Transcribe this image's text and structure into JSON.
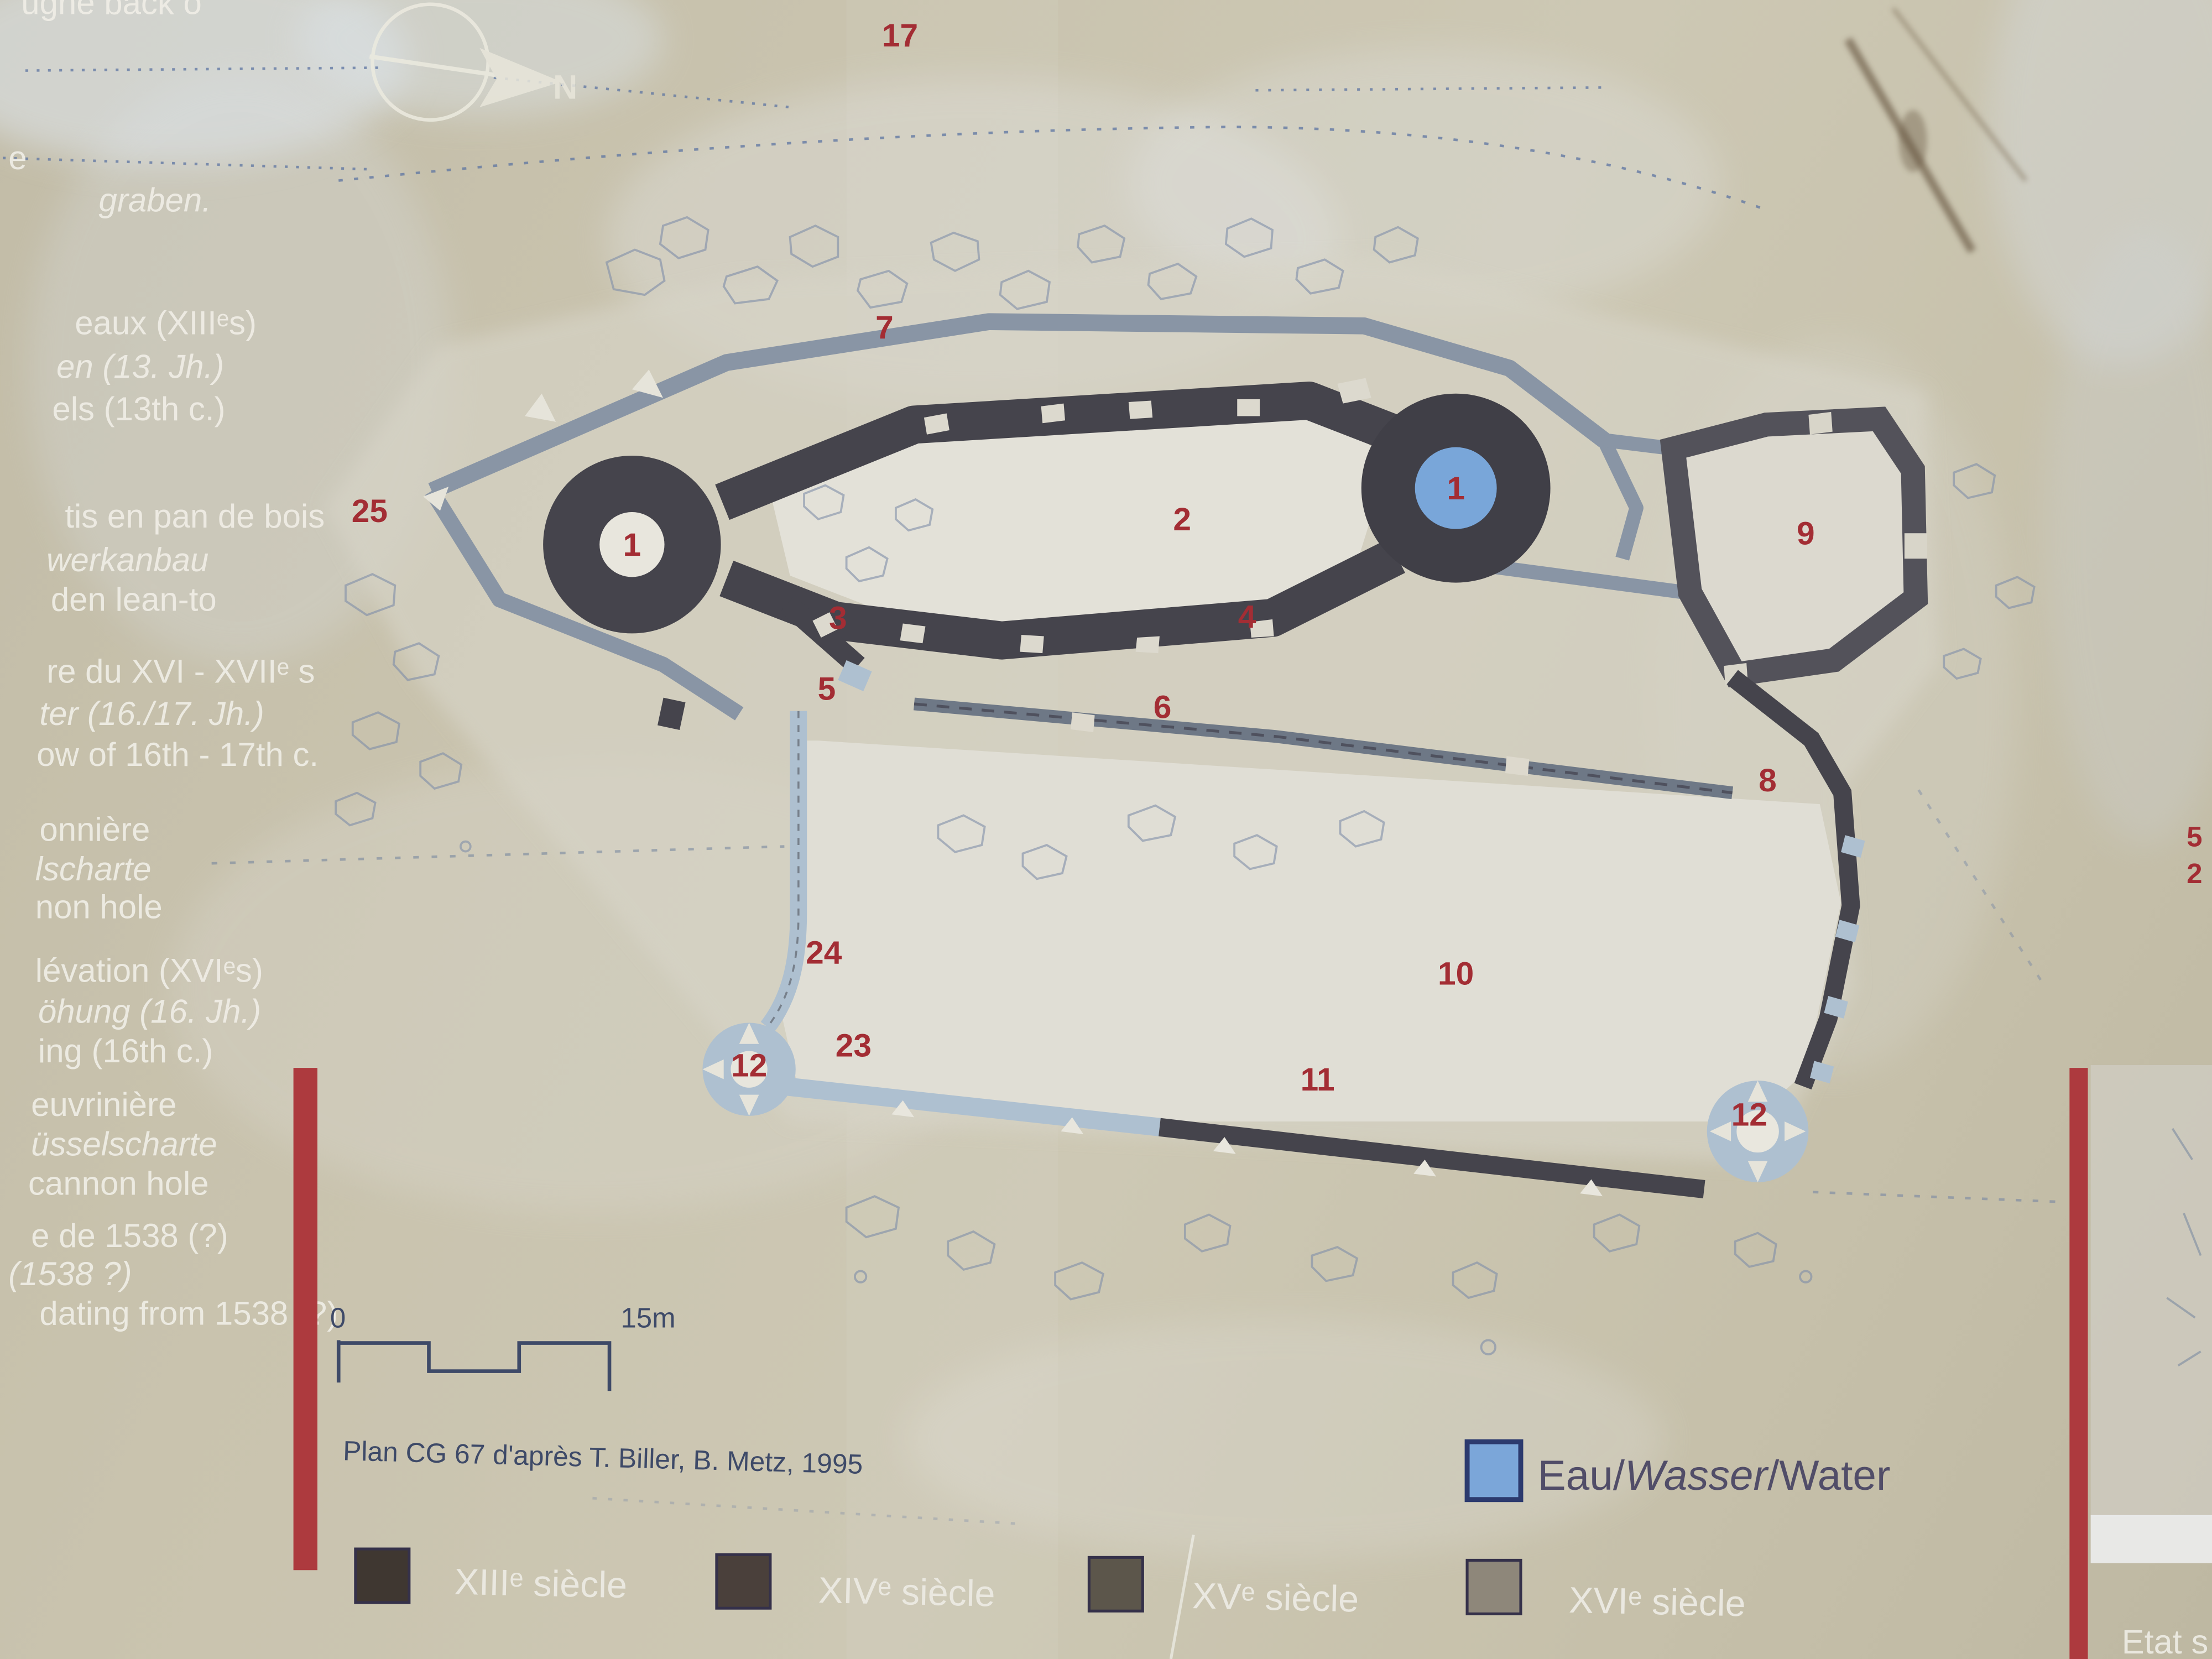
{
  "photo": {
    "top_left_partial_text": "ugne back o"
  },
  "left_column": {
    "lines": [
      {
        "text": "e"
      },
      {
        "text": "graben."
      },
      {
        "text": "eaux (XIIIᵉs)"
      },
      {
        "text": "en (13. Jh.)"
      },
      {
        "text": "els (13th c.)"
      },
      {
        "text": "tis en pan de bois"
      },
      {
        "text": "werkanbau"
      },
      {
        "text": "den lean-to"
      },
      {
        "text": "re du XVI - XVIIᵉ s"
      },
      {
        "text": "ter (16./17. Jh.)"
      },
      {
        "text": "ow of 16th - 17th c."
      },
      {
        "text": "onnière"
      },
      {
        "text": "lscharte"
      },
      {
        "text": "non hole"
      },
      {
        "text": "lévation (XVIᵉs)"
      },
      {
        "text": "öhung (16. Jh.)"
      },
      {
        "text": "ing (16th c.)"
      },
      {
        "text": "euvrinière"
      },
      {
        "text": "üsselscharte"
      },
      {
        "text": "cannon hole"
      },
      {
        "text": "e de 1538 (?)"
      },
      {
        "text": "(1538 ?)"
      },
      {
        "text": "dating from 1538 (?)"
      }
    ]
  },
  "plan": {
    "markers": [
      {
        "label": "17"
      },
      {
        "label": "7"
      },
      {
        "label": "25"
      },
      {
        "label": "1"
      },
      {
        "label": "2"
      },
      {
        "label": "1"
      },
      {
        "label": "9"
      },
      {
        "label": "3"
      },
      {
        "label": "4"
      },
      {
        "label": "5"
      },
      {
        "label": "6"
      },
      {
        "label": "8"
      },
      {
        "label": "24"
      },
      {
        "label": "10"
      },
      {
        "label": "23"
      },
      {
        "label": "12"
      },
      {
        "label": "11"
      },
      {
        "label": "12"
      }
    ],
    "compass": {
      "label": "N"
    },
    "scale_bar": {
      "start": "0",
      "end": "15m"
    },
    "attribution": "Plan CG 67 d'après T. Biller, B. Metz, 1995"
  },
  "legend": {
    "water": {
      "label_fr": "Eau/",
      "label_de": "Wasser",
      "label_en": "/Water",
      "color": "#7ba6d9",
      "border": "#2c3a6e"
    },
    "centuries": [
      {
        "label": "XIIIᵉ siècle",
        "color": "#3f3731"
      },
      {
        "label": "XIVᵉ siècle",
        "color": "#4a403b"
      },
      {
        "label": "XVᵉ siècle",
        "color": "#5c564b"
      },
      {
        "label": "XVIᵉ siècle",
        "color": "#8e877a"
      }
    ]
  },
  "adjacent_panel": {
    "bottom_text": "Etat s",
    "edge_numbers": [
      "5",
      "2"
    ]
  },
  "colors": {
    "panel_beige": "#c6c0ab",
    "wall_dark_13c": "#45444c",
    "wall_outer_enceinte": "#8995a5",
    "wall_light_16c": "#aec0d0",
    "marker_red": "#a32d34",
    "accent_bar_red": "#ad3a3e",
    "ink_blue": "#3e4a68",
    "water_blue": "#7ba6d9"
  }
}
